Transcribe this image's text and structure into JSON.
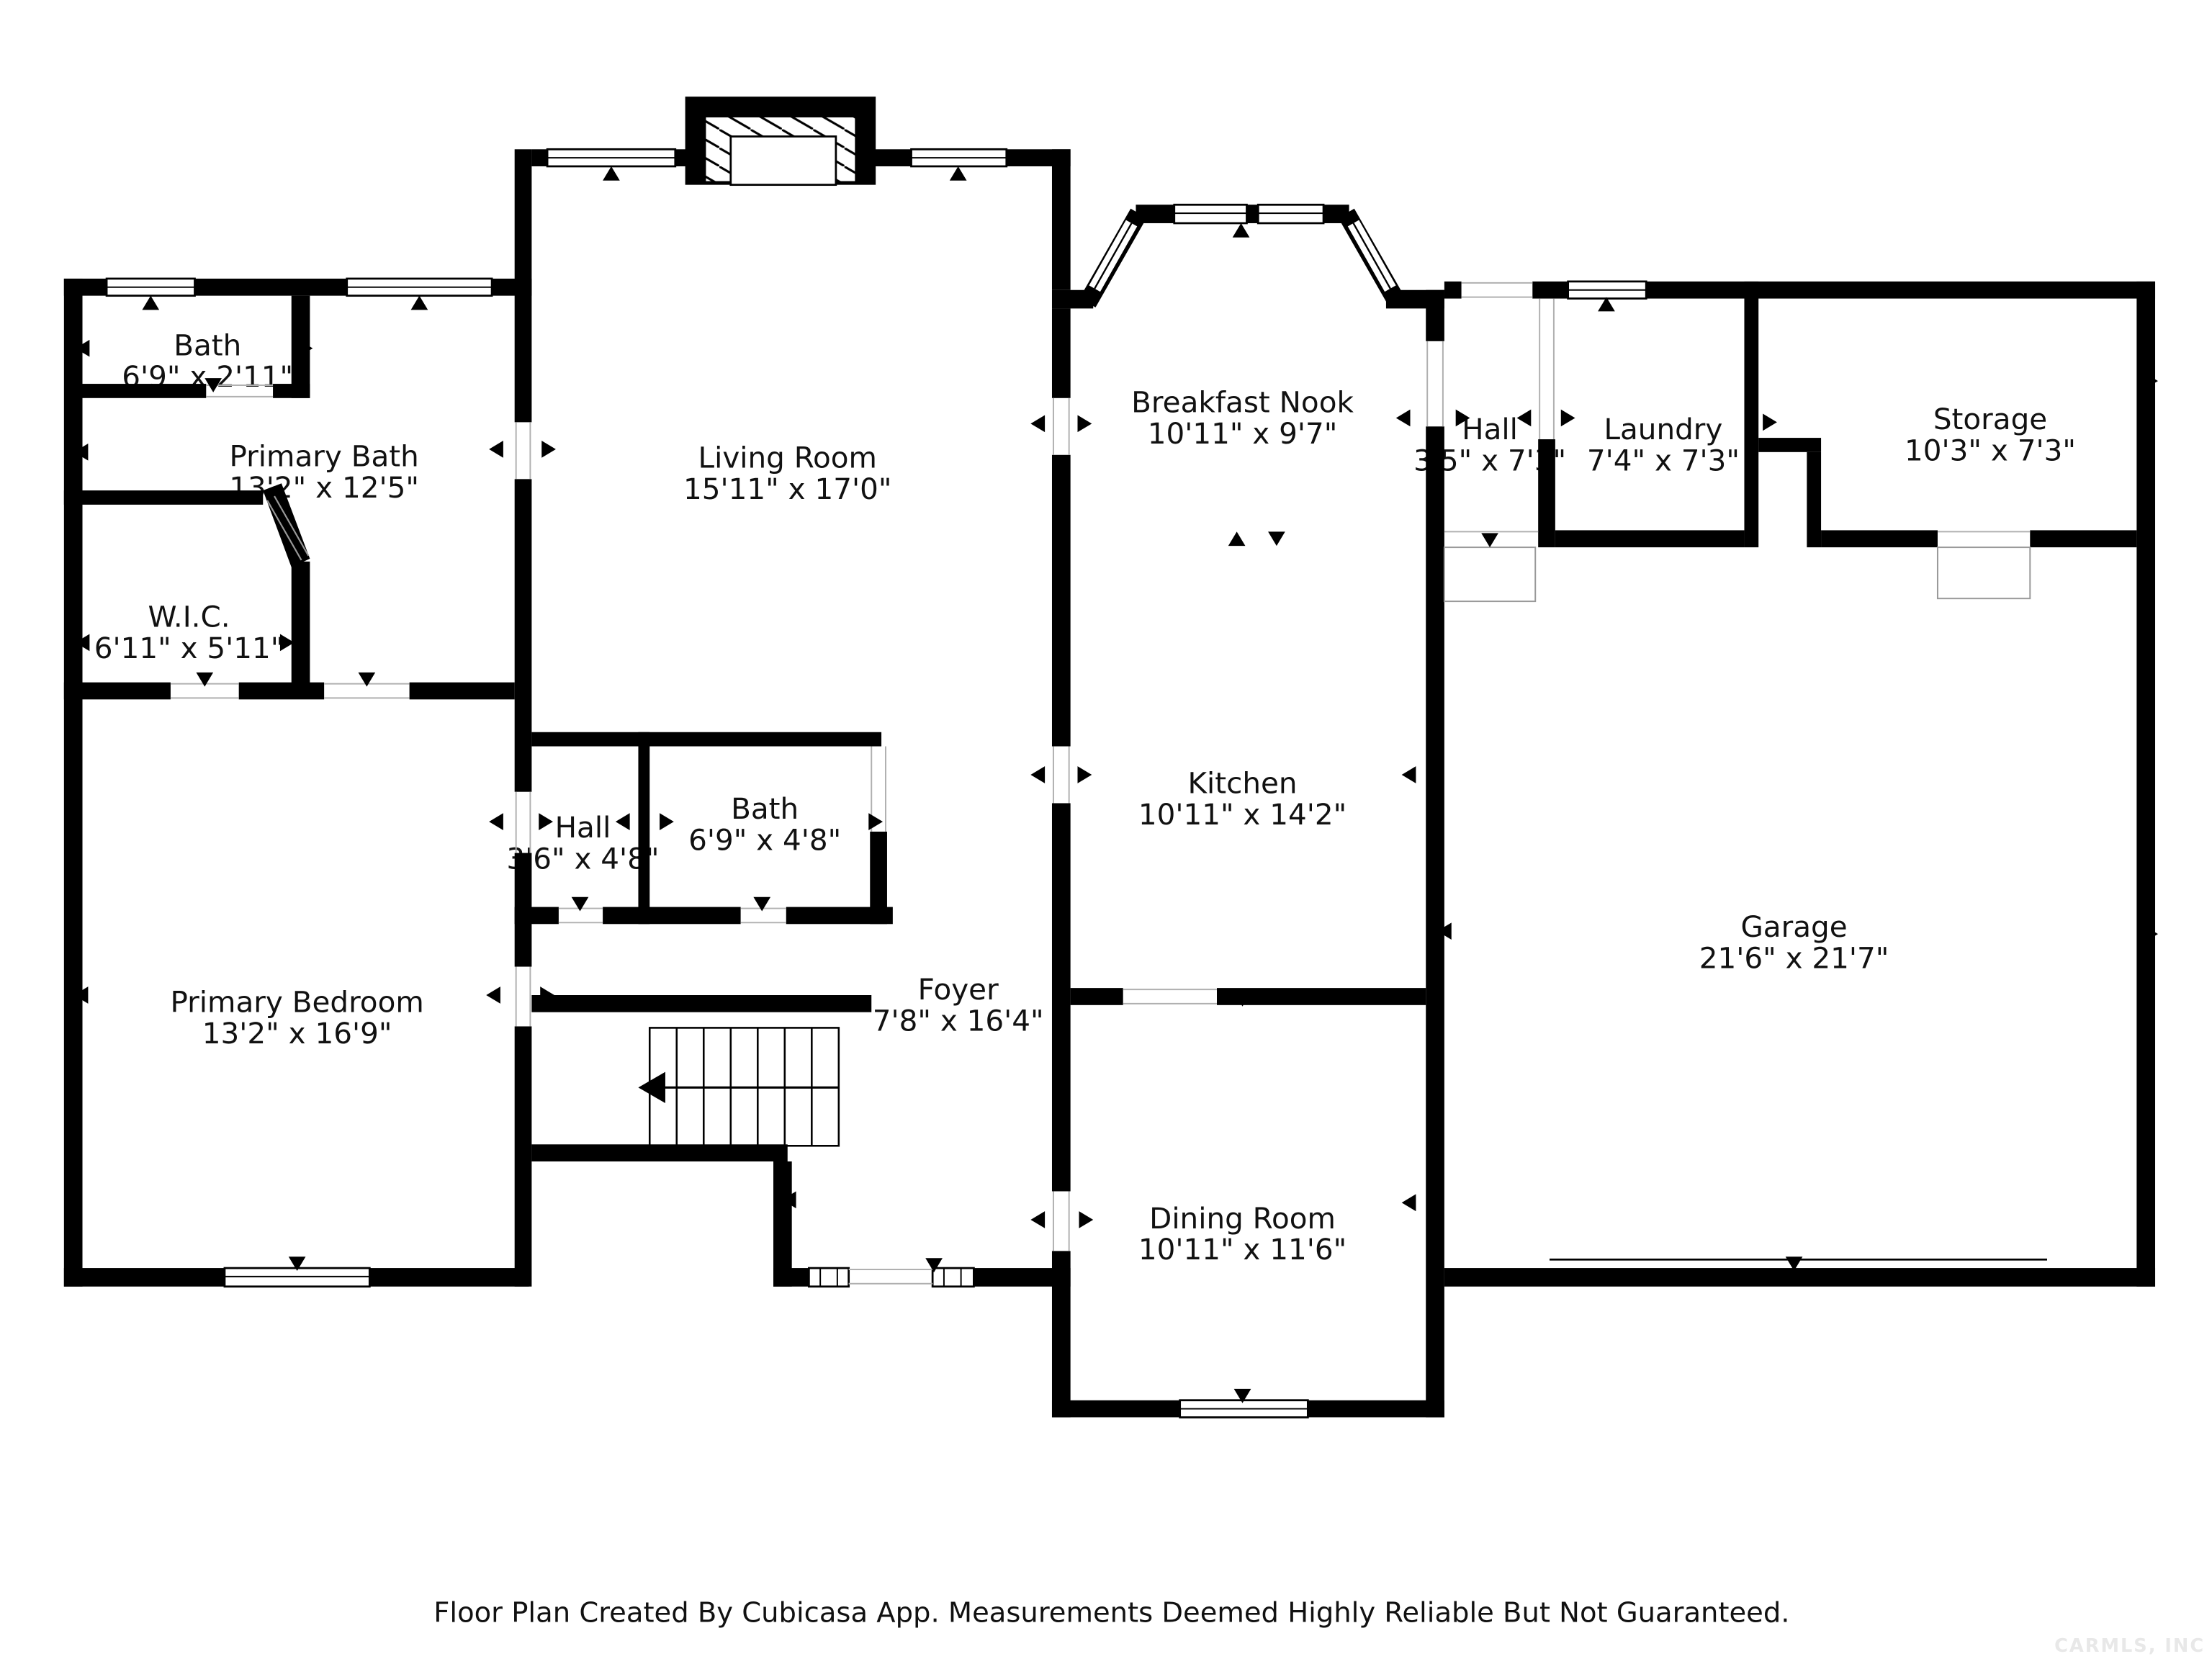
{
  "colors": {
    "wall": "#000000",
    "label": "#111111",
    "watermark": "#e8e8e8",
    "opening_line": "#b0b0b0",
    "background": "#ffffff"
  },
  "rooms": [
    {
      "id": "bath-upper",
      "name": "Bath",
      "dims": "6'9\" x 2'11\""
    },
    {
      "id": "primary-bath",
      "name": "Primary Bath",
      "dims": "13'2\" x 12'5\""
    },
    {
      "id": "wic",
      "name": "W.I.C.",
      "dims": "6'11\" x 5'11\""
    },
    {
      "id": "primary-bedroom",
      "name": "Primary Bedroom",
      "dims": "13'2\" x 16'9\""
    },
    {
      "id": "living-room",
      "name": "Living Room",
      "dims": "15'11\" x 17'0\""
    },
    {
      "id": "hall-middle",
      "name": "Hall",
      "dims": "3'6\" x 4'8\""
    },
    {
      "id": "bath-middle",
      "name": "Bath",
      "dims": "6'9\" x 4'8\""
    },
    {
      "id": "foyer",
      "name": "Foyer",
      "dims": "7'8\" x 16'4\""
    },
    {
      "id": "breakfast-nook",
      "name": "Breakfast Nook",
      "dims": "10'11\" x 9'7\""
    },
    {
      "id": "kitchen",
      "name": "Kitchen",
      "dims": "10'11\" x 14'2\""
    },
    {
      "id": "dining-room",
      "name": "Dining Room",
      "dims": "10'11\" x 11'6\""
    },
    {
      "id": "hall-right",
      "name": "Hall",
      "dims": "3'5\" x 7'3\""
    },
    {
      "id": "laundry",
      "name": "Laundry",
      "dims": "7'4\" x 7'3\""
    },
    {
      "id": "storage",
      "name": "Storage",
      "dims": "10'3\" x 7'3\""
    },
    {
      "id": "garage",
      "name": "Garage",
      "dims": "21'6\" x 21'7\""
    }
  ],
  "footer": {
    "text": "Floor Plan Created By Cubicasa App. Measurements Deemed Highly Reliable But Not Guaranteed."
  },
  "watermark": {
    "text": "CARMLS, INC"
  }
}
